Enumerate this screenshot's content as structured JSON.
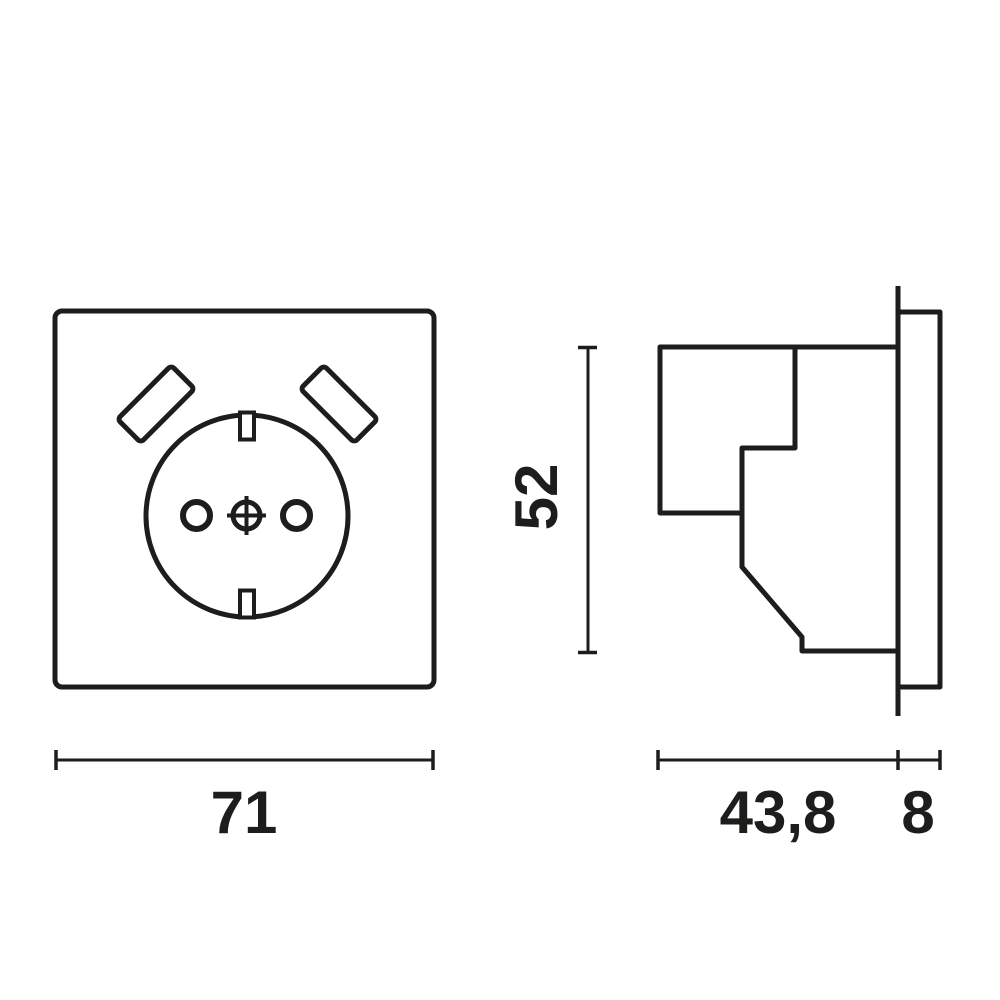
{
  "page": {
    "background_color": "#ffffff",
    "line_color": "#1d1d1b"
  },
  "figure": {
    "type": "technical-drawing",
    "subject": "schuko-socket-outlet-with-two-usb-slots",
    "views": [
      "front-view",
      "side-profile-view"
    ],
    "front_view": {
      "width_label": "71"
    },
    "side_view": {
      "height_label": "52",
      "depth_label": "43,8",
      "frame_thickness_label": "8"
    }
  }
}
